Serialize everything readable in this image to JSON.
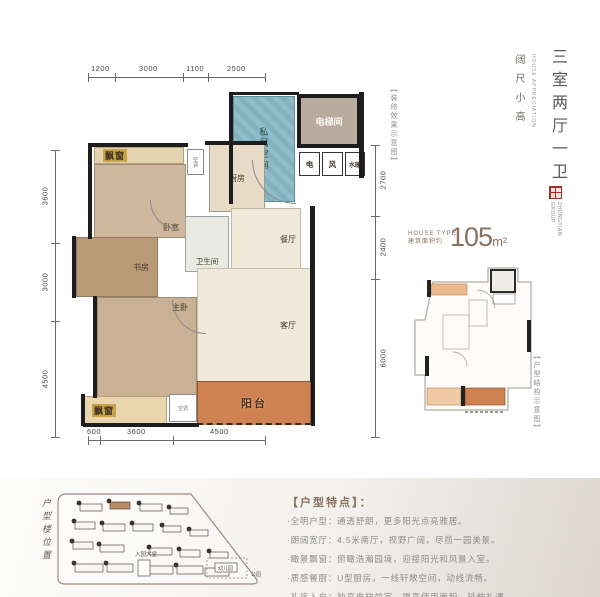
{
  "colors": {
    "private_space_blue": "#8fbdc9",
    "balcony_orange": "#cf8352",
    "seal_red": "#a33226",
    "accent_brown": "#8a7260",
    "wall_black": "#1d1d1d"
  },
  "dimensions": {
    "top": [
      "1200",
      "3000",
      "1100",
      "2500"
    ],
    "left": [
      "3600",
      "3000",
      "4500"
    ],
    "right": [
      "2700",
      "2400",
      "6000"
    ],
    "bottom": [
      "600",
      "3600",
      "4500"
    ]
  },
  "floorplan": {
    "rooms": {
      "private_space": "私属空间",
      "elevator": "电梯间",
      "electric": "电",
      "wind": "风",
      "water_heating": "水暖",
      "bay_window_top": "飘窗",
      "bedroom": "卧室",
      "ac_top": "空调",
      "kitchen": "厨房",
      "bathroom": "卫生间",
      "dining": "餐厅",
      "study": "书房",
      "master_bedroom": "主卧",
      "living": "客厅",
      "balcony": "阳台",
      "bay_window_bottom": "飘窗",
      "ac_bottom": "空调"
    },
    "render_note": "【装修效果示意图】"
  },
  "right_panel": {
    "title_vertical": "三室两厅一卫",
    "subtitle_vertical": "阔尺小高",
    "subtitle_en": "HOUSE APPRECIATION",
    "brand_en": "ZHONGTIAN GROUP",
    "house_type_en": "HOUSE TYPE",
    "area_label": "建筑面积约",
    "area_value": "105",
    "area_unit": "m²",
    "mini_plan_note": "【户型结构示意图】"
  },
  "bottom": {
    "site_label_vertical": "户型楼位置",
    "site_labels": {
      "lobby": "入园大堂",
      "kindergarten": "幼儿园",
      "park": "公园"
    },
    "features_title": "【户型特点】：",
    "features": [
      "·全明户型：通透舒朗，更多阳光点亮雅居。",
      "·朗阔宽厅：4.5米南厅，视野广阔，尽揽一园美景。",
      "·瞰景飘窗：俯瞰浩瀚园境，迎接阳光和风景入室。",
      "·质感餐厨：U型厨房，一线轩敞空间，动线流畅。",
      "·礼序入户：独享电梯前室，提高使用面积，延伸礼遇。"
    ]
  }
}
